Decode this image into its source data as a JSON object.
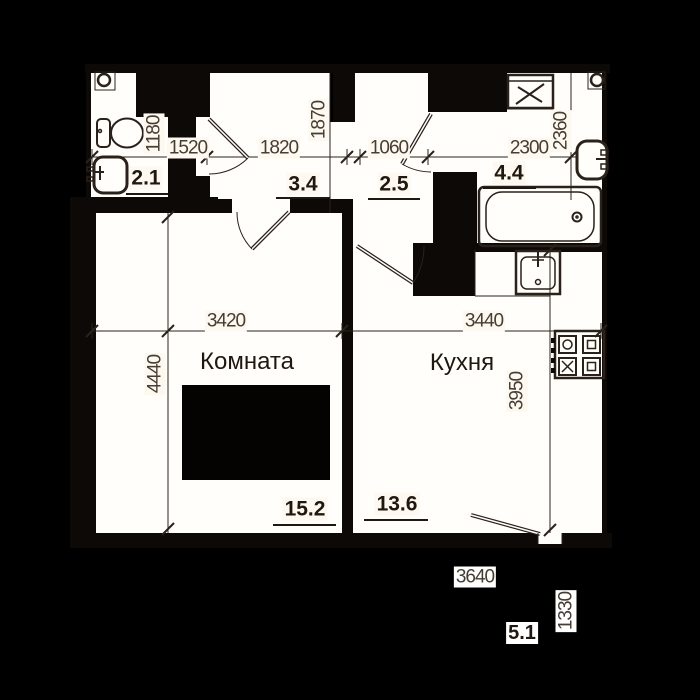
{
  "title": "apartment floor plan",
  "rooms": {
    "living": "Комната",
    "kitchen": "Кухня"
  },
  "areas": {
    "bath_left": "2.1",
    "hall": "3.4",
    "corridor": "2.5",
    "bath_right": "4.4",
    "living": "15.2",
    "kitchen": "13.6",
    "balcony": "5.1"
  },
  "dims": {
    "d1180": "1180",
    "d1520": "1520",
    "d1820": "1820",
    "d1870": "1870",
    "d1060": "1060",
    "d2300": "2300",
    "d2360": "2360",
    "d3420": "3420",
    "d3440": "3440",
    "d4440": "4440",
    "d3950": "3950",
    "d3640": "3640",
    "d1330": "1330"
  },
  "colors": {
    "background": "#000000",
    "room_fill": "#fffefa",
    "wall": "#0d0906",
    "line": "#2a211a",
    "dim_text": "#463d33",
    "label_text": "#1f1811",
    "chip_bg": "#fdf8f0"
  },
  "fixtures": [
    "vent",
    "toilet",
    "sink",
    "washing-machine",
    "wall-sink",
    "bathtub",
    "kitchen-sink",
    "stove"
  ]
}
